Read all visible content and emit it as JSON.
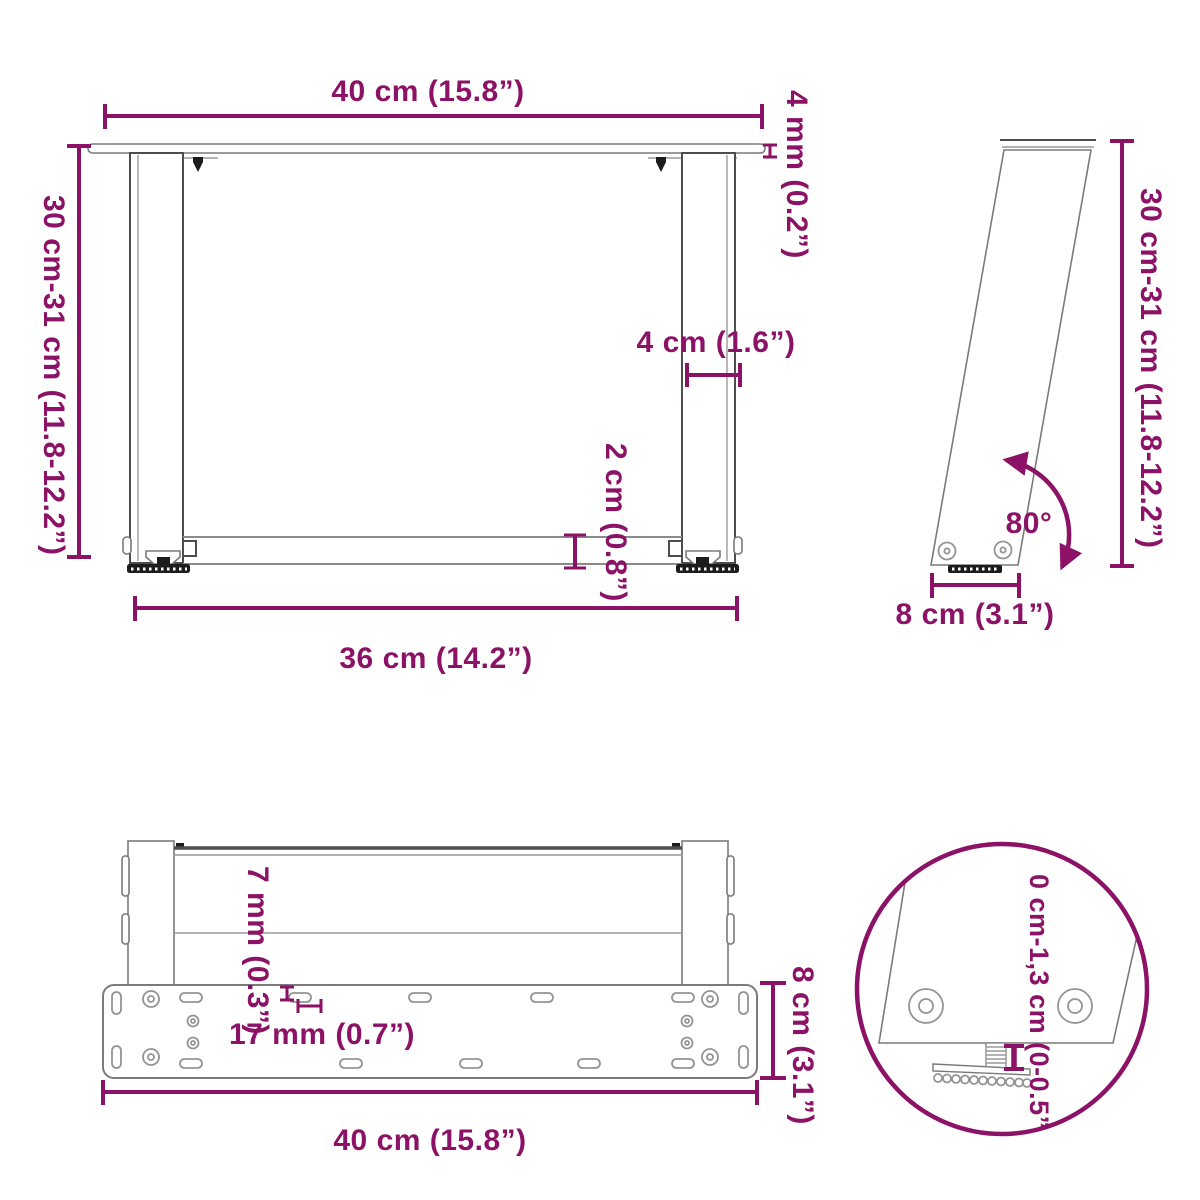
{
  "colors": {
    "accent": "#8B1266",
    "line_dark": "#4d4d4d",
    "line_gray": "#8a8a8a"
  },
  "views": {
    "front": {
      "width_top": "40 cm (15.8”)",
      "top_plate_thickness": "4 mm (0.2”)",
      "height_range": "30 cm-31 cm (11.8-12.2”)",
      "leg_width": "4 cm (1.6”)",
      "crossbar_thickness": "2 cm (0.8”)",
      "width_bottom": "36 cm (14.2”)"
    },
    "side": {
      "height_range": "30 cm-31 cm (11.8-12.2”)",
      "tilt_angle": "80°",
      "base_depth": "8 cm (3.1”)"
    },
    "bottom": {
      "plate_thickness": "7 mm (0.3”)",
      "hole_offset": "17 mm (0.7”)",
      "plate_depth": "8 cm (3.1”)",
      "width": "40 cm (15.8”)"
    },
    "detail": {
      "foot_adjust_range": "0 cm-1,3 cm (0-0.5”)"
    }
  }
}
